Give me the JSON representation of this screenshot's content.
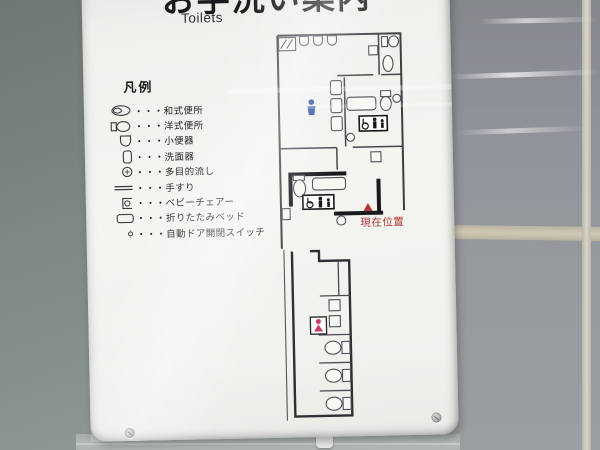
{
  "sign": {
    "title_ja": "お手洗い案内",
    "title_en": "Toilets"
  },
  "legend": {
    "heading": "凡例",
    "items": [
      {
        "icon": "squat-toilet-icon",
        "label": "・・・和式便所"
      },
      {
        "icon": "western-toilet-icon",
        "label": "・・・洋式便所"
      },
      {
        "icon": "urinal-icon",
        "label": "・・・小便器"
      },
      {
        "icon": "washbasin-icon",
        "label": "・・・洗面器"
      },
      {
        "icon": "multipurpose-sink-icon",
        "label": "・・・多目的流し"
      },
      {
        "icon": "handrail-icon",
        "label": "・・・手すり"
      },
      {
        "icon": "baby-chair-icon",
        "label": "・・・ベビーチェアー"
      },
      {
        "icon": "folding-bed-icon",
        "label": "・・・折りたたみベッド"
      },
      {
        "icon": "auto-door-switch-icon",
        "label": "・・・自動ドア開閉スイッチ"
      }
    ]
  },
  "floor_plan": {
    "current_location_label": "現在位置",
    "markers": {
      "mens_icon": "male-figure",
      "womens_icon": "female-figure",
      "accessible_sign": "wheelchair-person-baby-sign"
    },
    "colors": {
      "male": "#2b55a8",
      "female": "#cc3a6b",
      "current_location": "#b23434",
      "walls": "#3e3e45"
    }
  }
}
